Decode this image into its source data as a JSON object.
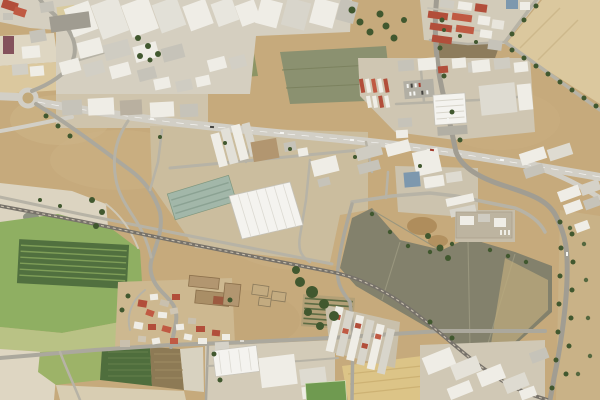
{
  "map": {
    "mode": "satellite",
    "colors": {
      "base": "#c6aa7c",
      "dirt_light": "#d2ba8e",
      "dirt_pale": "#ded6c2",
      "scrub": "#bca97c",
      "quarry": "#dcd4c1",
      "road_pale": "#d2cfc6",
      "road_mid": "#aba89d",
      "road_minor": "#b7b3a6",
      "asphalt": "#a19d92",
      "rail": "#77726a",
      "rail_tie": "#cbc2b0",
      "roof_white": "#efede6",
      "roof_bright": "#f4f3ef",
      "roof_gray": "#c6c3b9",
      "roof_gray_dark": "#a09c91",
      "roof_red": "#b24e3a",
      "roof_red_light": "#c05a43",
      "roof_cream": "#d9cb9f",
      "roof_teal": "#a2b7a9",
      "roof_tan": "#b29670",
      "roof_blue": "#7d98ae",
      "roof_purple": "#84525c",
      "field_olive": "#8d9565",
      "field_graygreen": "#8b9170",
      "field_gray_dark": "#83816c",
      "field_green": "#8faf62",
      "field_dark_rows": "#51703f",
      "field_pale_green": "#b9c285",
      "field_brown": "#8d7c5c",
      "field_tan": "#dbc89e",
      "field_wheat": "#dcc487",
      "stripe_green": "#9db368",
      "stripe_dark": "#4f6e3d",
      "stripe_brown": "#8d7a55",
      "stripe_pale": "#d8d2c0",
      "tree": "#41582f",
      "tree_light": "#55683f",
      "pitch": "#6f9a50",
      "pond": "#8e9282",
      "lot": "#cbbd9e",
      "urban": "#d5cfc0",
      "car_white": "#f5f5f2",
      "car_dark": "#44433f"
    }
  }
}
